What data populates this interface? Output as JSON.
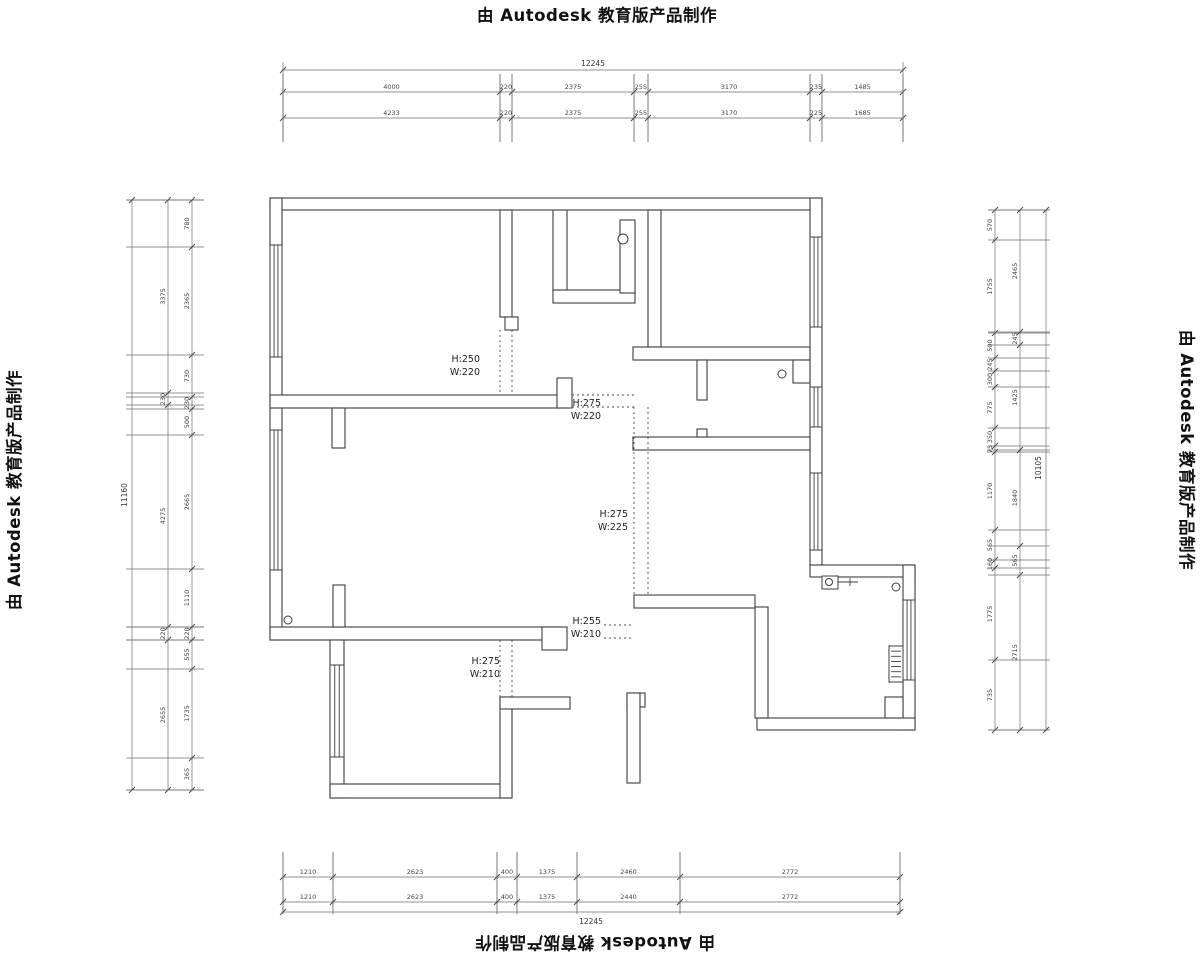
{
  "branding": {
    "text": "由 Autodesk 教育版产品制作"
  },
  "door_labels": [
    {
      "h": "H:250",
      "w": "W:220",
      "x": 480,
      "y": 362
    },
    {
      "h": "H:275",
      "w": "W:220",
      "x": 601,
      "y": 406
    },
    {
      "h": "H:275",
      "w": "W:225",
      "x": 628,
      "y": 517
    },
    {
      "h": "H:255",
      "w": "W:210",
      "x": 601,
      "y": 624
    },
    {
      "h": "H:275",
      "w": "W:210",
      "x": 500,
      "y": 664
    }
  ],
  "dimensions": {
    "top": {
      "total": {
        "label": "12245",
        "line_y": 70,
        "x1": 283,
        "x2": 903,
        "label_x": 593,
        "label_y": 66
      },
      "ext_y1": 74,
      "ext_y2": 142,
      "rows": [
        {
          "line_y": 92,
          "ticks": [
            283,
            500,
            512,
            634,
            648,
            810,
            822,
            903
          ],
          "values": [
            "4000",
            "220",
            "2375",
            "255",
            "3170",
            "235",
            "1485"
          ]
        },
        {
          "line_y": 118,
          "ticks": [
            283,
            500,
            512,
            634,
            648,
            810,
            822,
            903
          ],
          "values": [
            "4233",
            "220",
            "2375",
            "255",
            "3170",
            "225",
            "1685"
          ]
        }
      ]
    },
    "bottom": {
      "total": {
        "label": "12245",
        "line_y": 912,
        "x1": 283,
        "x2": 900,
        "label_x": 591,
        "label_y": 924
      },
      "ext_y1": 852,
      "ext_y2": 914,
      "rows": [
        {
          "line_y": 877,
          "ticks": [
            283,
            333,
            497,
            517,
            577,
            680,
            900
          ],
          "values": [
            "1210",
            "2623",
            "400",
            "1375",
            "2460",
            "2772"
          ]
        },
        {
          "line_y": 902,
          "ticks": [
            283,
            333,
            497,
            517,
            577,
            680,
            900
          ],
          "values": [
            "1210",
            "2623",
            "400",
            "1375",
            "2440",
            "2772"
          ]
        }
      ]
    },
    "left": {
      "total": {
        "label": "11160",
        "line_x": 132,
        "y1": 200,
        "y2": 790,
        "label_x": 127,
        "label_y": 495
      },
      "ext_x1": 126,
      "ext_x2": 204,
      "cols": [
        {
          "line_x": 168,
          "ticks": [
            200,
            393,
            405,
            627,
            640,
            790
          ],
          "values": [
            "3375",
            "230",
            "4275",
            "220",
            "2655"
          ]
        },
        {
          "line_x": 192,
          "ticks": [
            200,
            247,
            355,
            397,
            409,
            435,
            569,
            627,
            640,
            669,
            758,
            790
          ],
          "values": [
            "780",
            "2365",
            "730",
            "230",
            "500",
            "2665",
            "1110",
            "220",
            "555",
            "1735",
            "365"
          ]
        }
      ]
    },
    "right": {
      "total": {
        "label": "10105",
        "line_x": 1046,
        "y1": 210,
        "y2": 730,
        "label_x": 1041,
        "label_y": 468
      },
      "ext_x1": 988,
      "ext_x2": 1050,
      "cols": [
        {
          "line_x": 995,
          "ticks": [
            210,
            240,
            333,
            358,
            371,
            387,
            428,
            446,
            452,
            530,
            560,
            568,
            660,
            730
          ],
          "values": [
            "570",
            "1755",
            "500",
            "245",
            "300",
            "775",
            "350",
            "75",
            "1170",
            "565",
            "160",
            "1775",
            "735"
          ]
        },
        {
          "line_x": 1020,
          "ticks": [
            210,
            332,
            345,
            450,
            546,
            575,
            730
          ],
          "values": [
            "2465",
            "245",
            "1425",
            "1840",
            "565",
            "2715"
          ]
        }
      ]
    }
  },
  "geometry": {
    "walls": [
      [
        270,
        198,
        552,
        12
      ],
      [
        270,
        198,
        12,
        442
      ],
      [
        810,
        198,
        12,
        367
      ],
      [
        810,
        565,
        105,
        12
      ],
      [
        903,
        565,
        12,
        165
      ],
      [
        757,
        718,
        158,
        12
      ],
      [
        755,
        607,
        13,
        111
      ],
      [
        634,
        595,
        121,
        13
      ],
      [
        270,
        627,
        292,
        13
      ],
      [
        542,
        627,
        25,
        23
      ],
      [
        330,
        640,
        14,
        158
      ],
      [
        330,
        784,
        182,
        14
      ],
      [
        500,
        697,
        12,
        101
      ],
      [
        500,
        697,
        70,
        12
      ],
      [
        885,
        697,
        18,
        21
      ],
      [
        270,
        395,
        292,
        13
      ],
      [
        557,
        378,
        15,
        30
      ],
      [
        500,
        210,
        12,
        107
      ],
      [
        505,
        317,
        13,
        13
      ],
      [
        553,
        210,
        14,
        80
      ],
      [
        553,
        290,
        82,
        13
      ],
      [
        620,
        220,
        15,
        73
      ],
      [
        648,
        210,
        13,
        137
      ],
      [
        633,
        347,
        177,
        13
      ],
      [
        697,
        360,
        10,
        40
      ],
      [
        793,
        360,
        17,
        23
      ],
      [
        633,
        437,
        177,
        13
      ],
      [
        697,
        429,
        10,
        8
      ],
      [
        333,
        585,
        12,
        42
      ],
      [
        332,
        408,
        13,
        40
      ],
      [
        627,
        693,
        18,
        14
      ],
      [
        627,
        693,
        13,
        90
      ]
    ],
    "windows": [
      [
        270,
        245,
        12,
        112
      ],
      [
        270,
        430,
        12,
        140
      ],
      [
        330,
        665,
        14,
        92
      ],
      [
        810,
        237,
        12,
        90
      ],
      [
        810,
        387,
        12,
        40
      ],
      [
        810,
        473,
        12,
        77
      ],
      [
        903,
        600,
        12,
        80
      ]
    ],
    "circles": [
      [
        623,
        239,
        5
      ],
      [
        782,
        374,
        4
      ],
      [
        288,
        620,
        4
      ],
      [
        896,
        587,
        4
      ]
    ],
    "dashes": [
      [
        500,
        330,
        500,
        395
      ],
      [
        512,
        330,
        512,
        395
      ],
      [
        572,
        395,
        634,
        395
      ],
      [
        572,
        407,
        634,
        407
      ],
      [
        634,
        407,
        634,
        595
      ],
      [
        648,
        407,
        648,
        595
      ],
      [
        604,
        625,
        634,
        625
      ],
      [
        604,
        638,
        634,
        638
      ],
      [
        500,
        640,
        500,
        697
      ],
      [
        512,
        640,
        512,
        697
      ]
    ],
    "radiator": {
      "x": 889,
      "y": 646,
      "w": 14,
      "h": 36
    },
    "fixture": {
      "x": 822,
      "y": 576,
      "w": 16,
      "h": 13,
      "cx": 829,
      "cy": 582,
      "lx2": 858
    }
  }
}
